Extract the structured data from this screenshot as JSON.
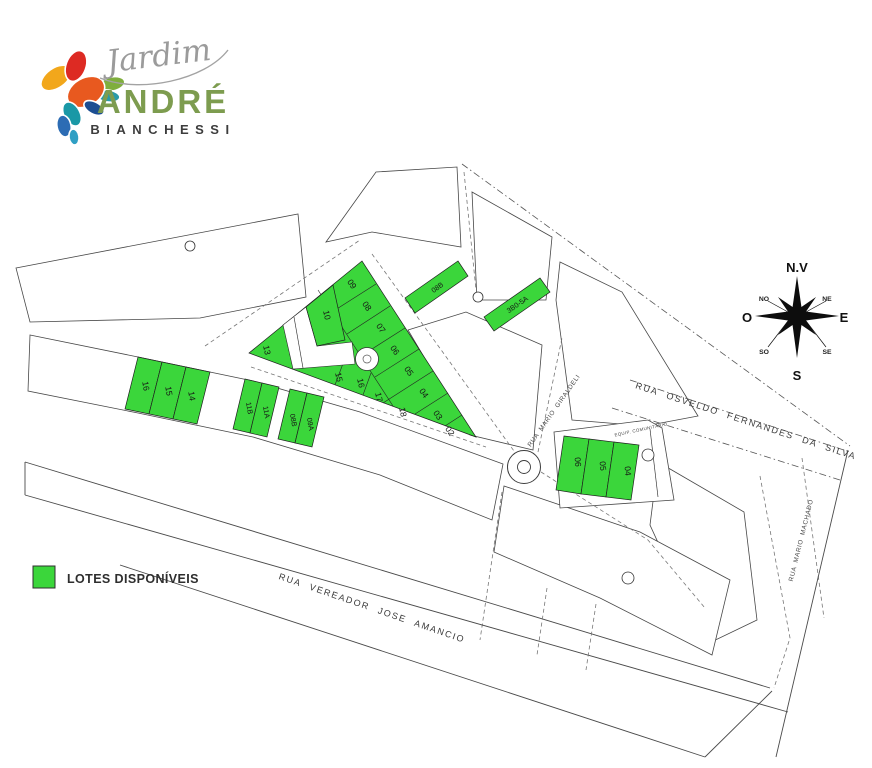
{
  "logo": {
    "script": "Jardim",
    "name": "ANDRÉ",
    "surname": "BIANCHESSI"
  },
  "legend": {
    "label": "LOTES DISPONÍVEIS"
  },
  "colors": {
    "available": "#3bd63b"
  },
  "compass": {
    "n": "N.V",
    "no": "NO",
    "ne": "NE",
    "o": "O",
    "e": "E",
    "so": "SO",
    "se": "SE",
    "s": "S"
  },
  "streets": {
    "vereador_jose_amancio": "RUA VEREADOR JOSE AMANCIO",
    "osvaldo_fernandes": "RUA OSVELDO FERNANDES DA SILVA",
    "mario_machado": "RUA MARIO MACHADO",
    "mario_giraldeli": "RUA MARIO GIRALDELI"
  },
  "annotations": {
    "equip_comunitario": "EQUIP. COMUNITÁRIO"
  },
  "lots": {
    "central": [
      "09",
      "08",
      "07",
      "06",
      "05",
      "04",
      "03",
      "02",
      "10",
      "13",
      "15",
      "16",
      "17",
      "18"
    ],
    "west": [
      "16",
      "15",
      "14"
    ],
    "southwest": [
      "11B",
      "11A",
      "08B",
      "09A"
    ],
    "north_corridor": [
      "08B",
      "3B0-5A"
    ],
    "east": [
      "06",
      "05",
      "04"
    ]
  }
}
